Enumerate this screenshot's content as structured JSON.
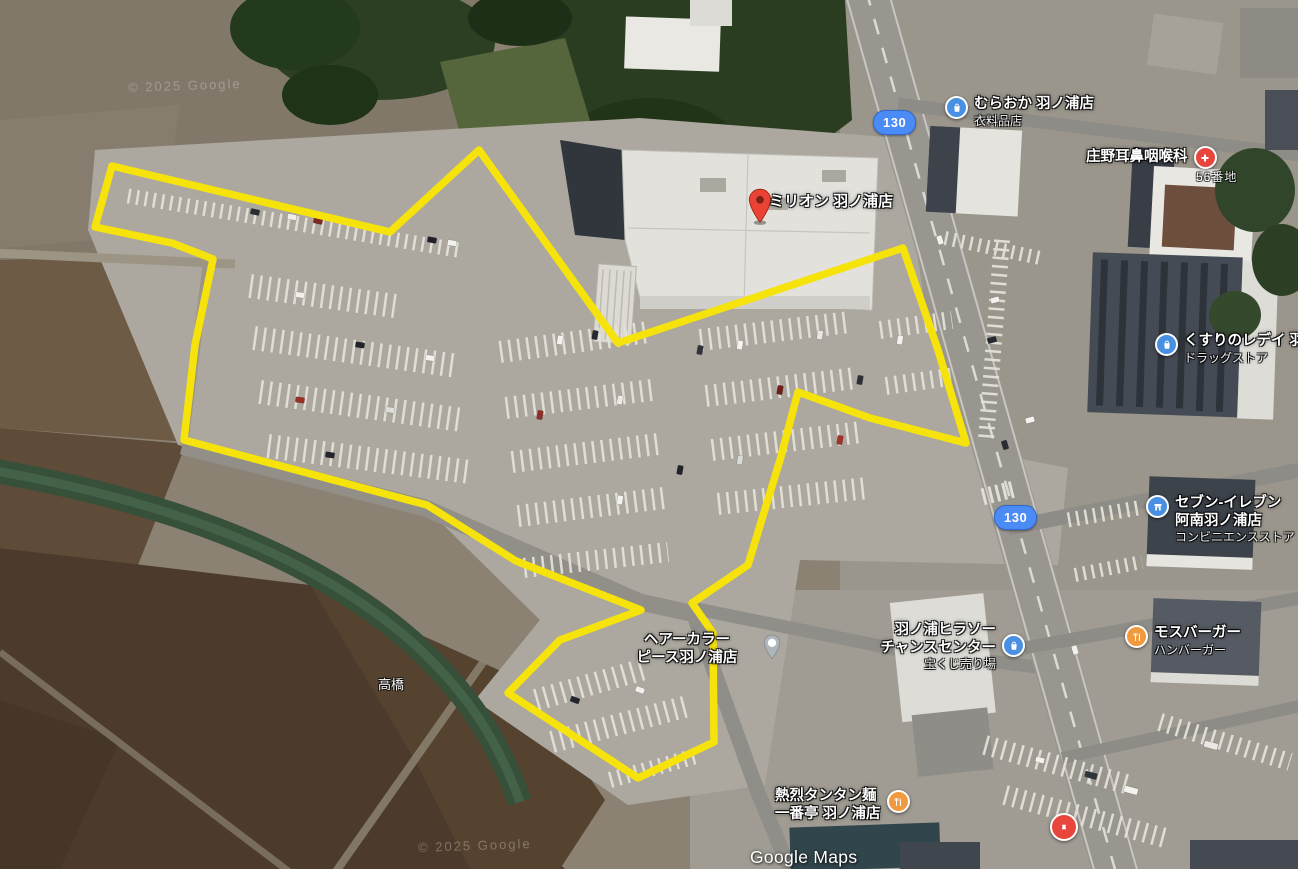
{
  "map": {
    "attribution": "Google Maps",
    "imagery_watermark": "© 2025 Google",
    "area_label": "高橋",
    "address_label": "56番地"
  },
  "pin": {
    "title": "ミリオン 羽ノ浦店",
    "color": "#ea4335"
  },
  "route_badges": [
    {
      "number": "130"
    },
    {
      "number": "130"
    }
  ],
  "places": [
    {
      "name": "むらおか 羽ノ浦店",
      "category": "衣料品店",
      "icon": "shopping-bag-icon",
      "color": "#4a90e2"
    },
    {
      "name": "庄野耳鼻咽喉科",
      "category": "",
      "icon": "hospital-cross-icon",
      "color": "#e8453c"
    },
    {
      "name": "くすりのレデイ 羽",
      "category": "ドラッグストア",
      "icon": "shopping-bag-icon",
      "color": "#4a90e2"
    },
    {
      "name": "セブン-イレブン",
      "name2": "阿南羽ノ浦店",
      "category": "コンビニエンスストア",
      "icon": "convenience-store-icon",
      "color": "#4a90e2"
    },
    {
      "name": "羽ノ浦ヒラソー",
      "name2": "チャンスセンター",
      "category": "宝くじ売り場",
      "icon": "shopping-bag-icon",
      "color": "#4a90e2"
    },
    {
      "name": "ヘアーカラー",
      "name2": "ピース羽ノ浦店",
      "category": "",
      "icon": "generic-pin-icon",
      "color": "#aeb6ba"
    },
    {
      "name": "モスバーガー",
      "category": "ハンバーガー",
      "icon": "restaurant-icon",
      "color": "#f0993e"
    },
    {
      "name": "熱烈タンタン麺",
      "name2": "一番亭 羽ノ浦店",
      "category": "",
      "icon": "restaurant-icon",
      "color": "#f0993e"
    },
    {
      "name": "",
      "category": "",
      "icon": "shrine-icon",
      "color": "#e8453c"
    }
  ],
  "overlay": {
    "stroke_color": "#f6e30c",
    "polygon_points": "112,166 390,232 479,150 618,343 903,248 938,350 966,443 870,418 798,392 780,460 748,565 692,603 713,633 714,742 638,778 508,693 560,640 641,610 516,561 427,505 184,440 195,345 213,259 172,243 95,227"
  }
}
